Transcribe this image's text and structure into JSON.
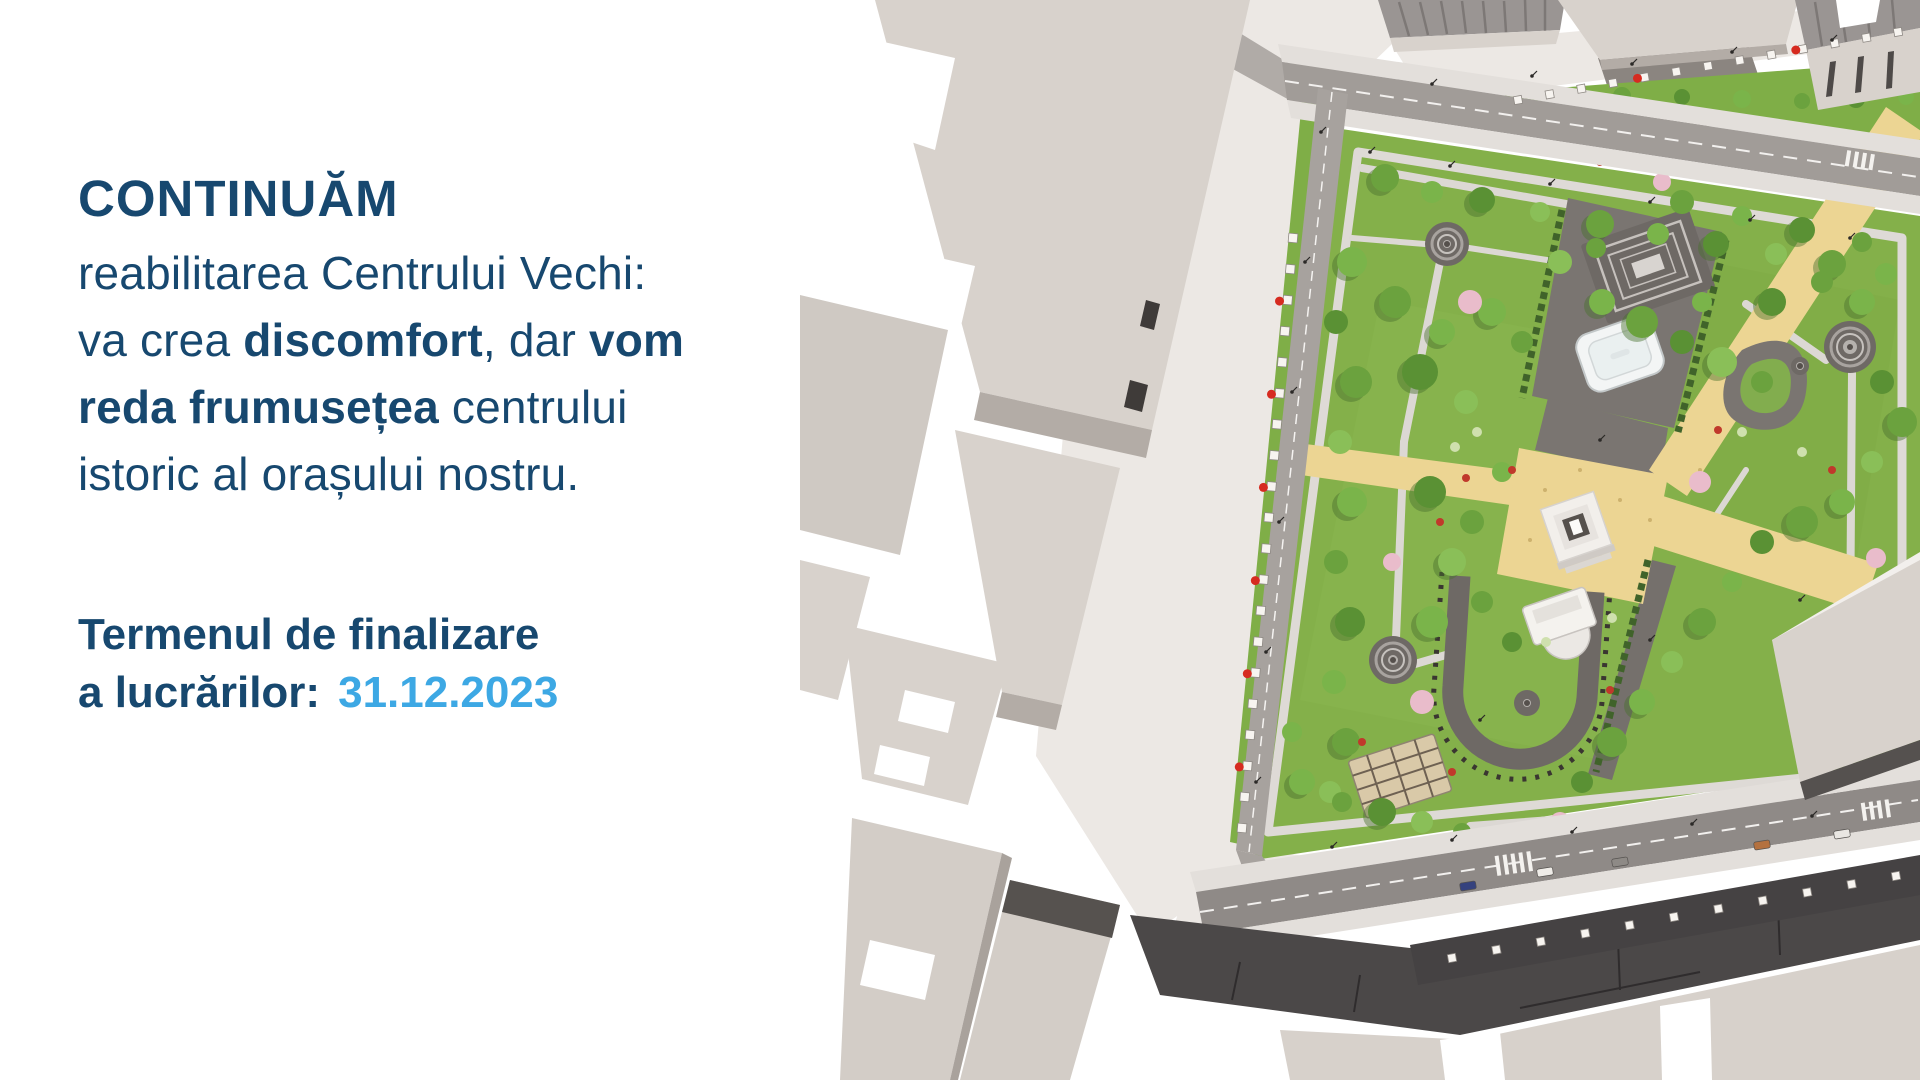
{
  "headline": {
    "title": "CONTINUĂM",
    "line1": "reabilitarea Centrului Vechi:",
    "line2": {
      "pre": "va crea ",
      "bold1": "discomfort",
      "mid": ", dar ",
      "bold2": "vom"
    },
    "line3": {
      "bold": "reda frumusețea",
      "post": " centrului"
    },
    "line4": "istoric al orașului nostru."
  },
  "deadline": {
    "line1": "Termenul de finalizare",
    "label": "a lucrărilor:",
    "date": "31.12.2023"
  },
  "colors": {
    "navy": "#17486f",
    "light_blue": "#3da8e4"
  }
}
